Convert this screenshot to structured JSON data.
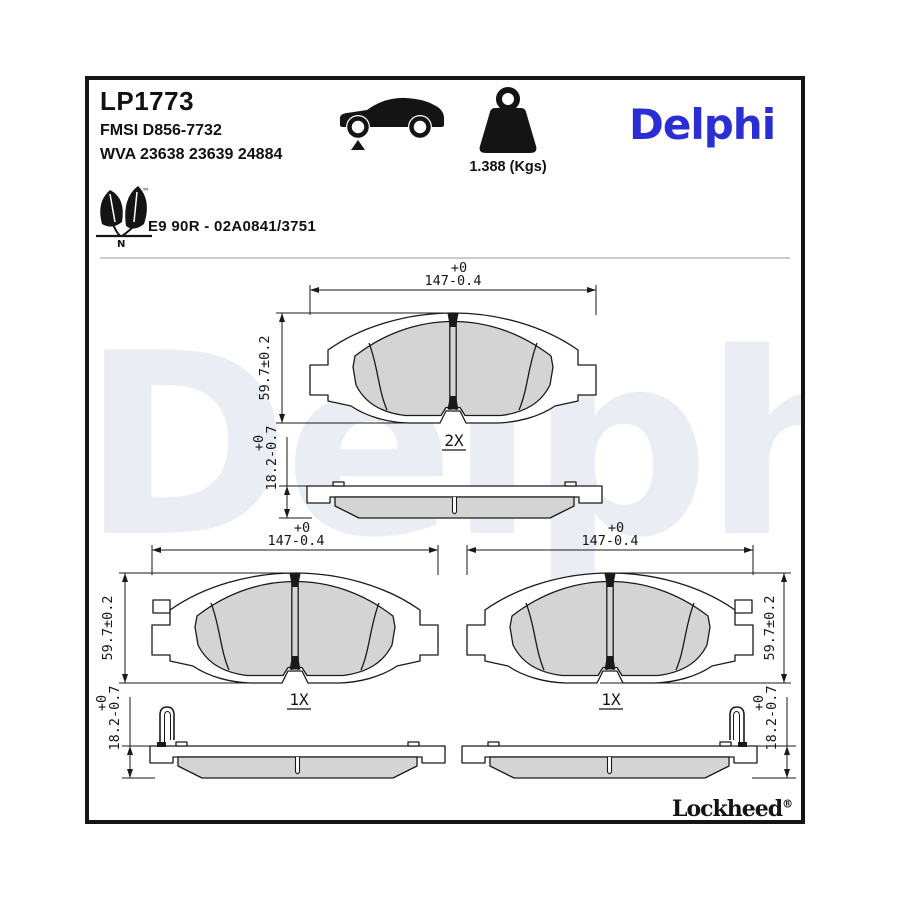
{
  "header": {
    "part_number": "LP1773",
    "fmsi": "FMSI D856-7732",
    "wva": "WVA 23638 23639 24884",
    "weight": "1.388 (Kgs)",
    "brand_logo": "Delphi"
  },
  "homologation": {
    "approval": "E9 90R - 02A0841/3751",
    "leaf_mark": "N",
    "trademark": "™"
  },
  "icons": {
    "vehicle": "car-side-icon",
    "mass": "weight-icon",
    "eco": "eco-leaf-icon"
  },
  "watermark": "Delphi",
  "footer": {
    "brand": "Lockheed",
    "registered": "®"
  },
  "drawings": {
    "top_pad": {
      "quantity": "2X",
      "width_tolerance": "+0",
      "width": "147-0.4",
      "height": "59.7±0.2",
      "thickness_tolerance": "+0",
      "thickness": "18.2-0.7"
    },
    "bottom_left_pad": {
      "quantity": "1X",
      "width_tolerance": "+0",
      "width": "147-0.4",
      "height": "59.7±0.2",
      "thickness_tolerance": "+0",
      "thickness": "18.2-0.7"
    },
    "bottom_right_pad": {
      "quantity": "1X",
      "width_tolerance": "+0",
      "width": "147-0.4",
      "height": "59.7±0.2",
      "thickness_tolerance": "+0",
      "thickness": "18.2-0.7"
    }
  },
  "colors": {
    "brand_blue": "#2B2ED3",
    "drawing_line": "#1a1a1a",
    "friction_gray": "#d4d4d4",
    "watermark_gray": "#EAEDF4",
    "divider_gray": "#cccccc"
  }
}
